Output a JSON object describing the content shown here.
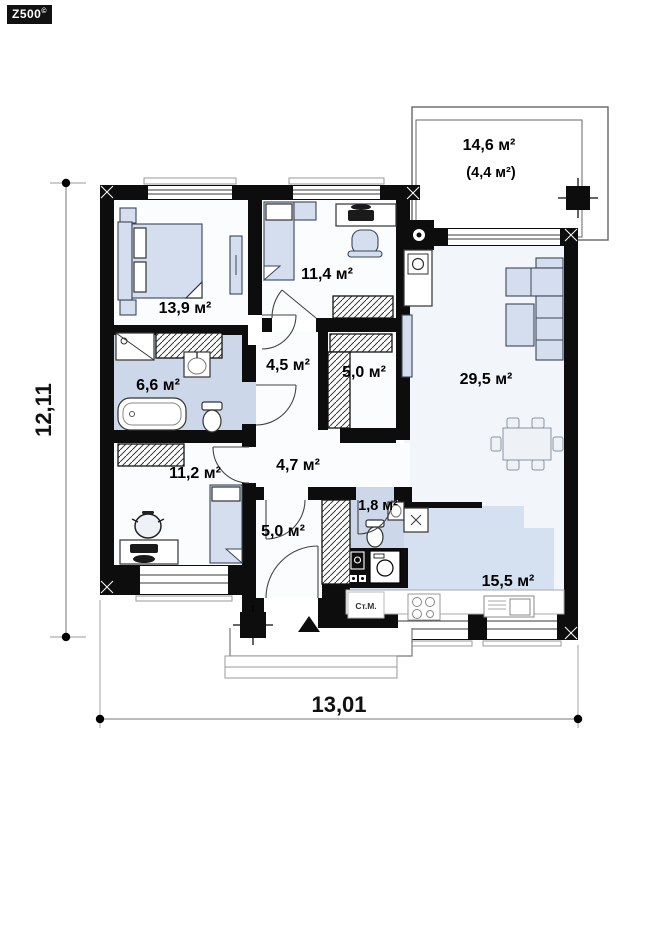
{
  "logo": {
    "text": "Z500",
    "sup": "©"
  },
  "dimensions": {
    "width": "13,01",
    "height": "12,11"
  },
  "rooms": {
    "terrace": {
      "area": "14,6 м²",
      "area_secondary": "(4,4 м²)"
    },
    "bedroom1": {
      "area": "13,9 м²"
    },
    "bedroom2": {
      "area": "11,4 м²"
    },
    "bathroom": {
      "area": "6,6 м²"
    },
    "hall": {
      "area": "4,5 м²"
    },
    "closet": {
      "area": "5,0 м²"
    },
    "living": {
      "area": "29,5 м²"
    },
    "corridor": {
      "area": "4,7 м²"
    },
    "bedroom3": {
      "area": "11,2 м²"
    },
    "entry": {
      "area": "5,0 м²"
    },
    "wc": {
      "area": "1,8 м²"
    },
    "kitchen": {
      "area": "15,5 м²"
    }
  },
  "labels": {
    "washing_machine": "Ст.М."
  },
  "colors": {
    "wall": "#0d0d0d",
    "wet_floor": "#ccd8e9",
    "kitchen_floor": "#d5e1f1",
    "living_floor": "#f2f6fb",
    "room_floor": "#fbfcfd",
    "furniture_fill": "#d4deef"
  }
}
